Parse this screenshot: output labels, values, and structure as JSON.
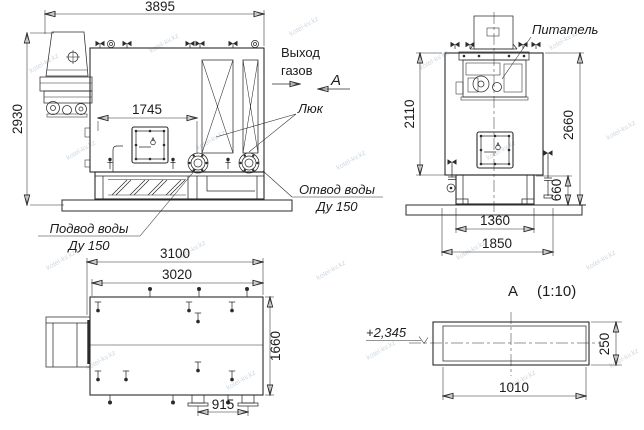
{
  "watermark": "kotel-kv.kz",
  "side_view": {
    "dim_length": "3895",
    "dim_height": "2930",
    "dim_door": "1745",
    "label_gas_1": "Выход",
    "label_gas_2": "газов",
    "label_hatch": "Люк",
    "label_outlet_1": "Отвод воды",
    "label_outlet_2": "Ду 150",
    "label_supply_1": "Подвод воды",
    "label_supply_2": "Ду 150",
    "view_arrow": "А"
  },
  "front_view": {
    "label_feeder": "Питатель",
    "dim_body_height": "2110",
    "dim_total_height": "2660",
    "dim_base_height": "660",
    "dim_base_inner": "1360",
    "dim_base_outer": "1850"
  },
  "plan_view": {
    "dim_outer": "3100",
    "dim_inner": "3020",
    "dim_width": "1660",
    "dim_pipes": "915"
  },
  "detail_view": {
    "title": "А",
    "scale": "(1:10)",
    "elevation": "+2,345",
    "dim_width": "1010",
    "dim_height": "250"
  }
}
